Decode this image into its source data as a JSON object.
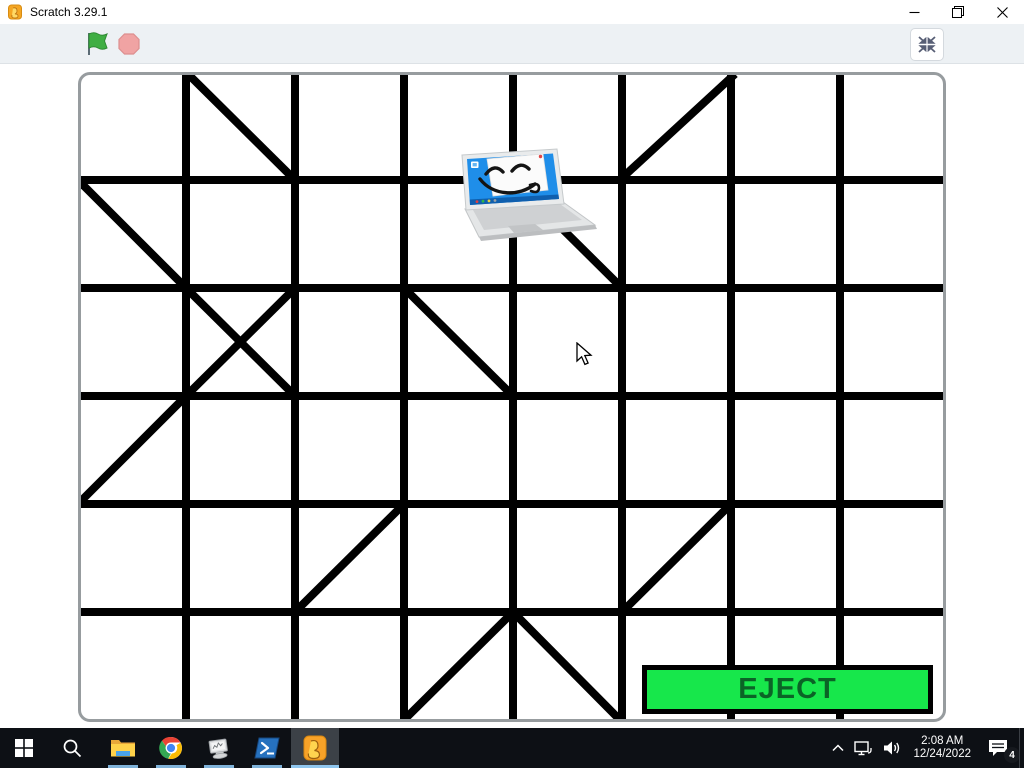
{
  "window": {
    "title": "Scratch 3.29.1",
    "app_icon": "scratch-app-icon",
    "controls": {
      "minimize": "minimize",
      "restore": "restore-down",
      "close": "close"
    }
  },
  "control_bar": {
    "green_flag_icon": "green-flag",
    "stop_icon": "stop-sign",
    "fullscreen_icon": "exit-fullscreen",
    "flag_color": "#3fae43",
    "stop_color": "#f0a3a3"
  },
  "stage": {
    "background": "#ffffff",
    "sprite": {
      "name": "laptop-character",
      "screen_color": "#1f8ee9"
    },
    "eject_button": {
      "label": "EJECT",
      "fill": "#17e74b",
      "text_color": "#0b6326",
      "border_color": "#000000"
    },
    "maze": {
      "line_color": "#000000",
      "line_width": 8,
      "width": 868,
      "height": 650,
      "verticals": [
        108,
        217,
        326,
        435,
        544,
        653,
        762
      ],
      "horizontals": [
        108,
        216,
        324,
        432,
        540
      ],
      "diagonals": [
        [
          108,
          0,
          217,
          108
        ],
        [
          544,
          106,
          657,
          2
        ],
        [
          0,
          108,
          108,
          216
        ],
        [
          435,
          108,
          544,
          216
        ],
        [
          108,
          216,
          217,
          324
        ],
        [
          217,
          216,
          108,
          324
        ],
        [
          326,
          216,
          435,
          324
        ],
        [
          0,
          432,
          108,
          324
        ],
        [
          217,
          540,
          326,
          432
        ],
        [
          544,
          540,
          653,
          432
        ],
        [
          326,
          648,
          435,
          540
        ],
        [
          435,
          540,
          544,
          650
        ]
      ]
    }
  },
  "taskbar": {
    "apps": [
      {
        "name": "start",
        "running": false
      },
      {
        "name": "search",
        "running": false
      },
      {
        "name": "file-explorer",
        "running": true
      },
      {
        "name": "chrome",
        "running": true
      },
      {
        "name": "utility-app",
        "running": true
      },
      {
        "name": "powershell",
        "running": true
      },
      {
        "name": "scratch",
        "running": true,
        "active": true
      }
    ],
    "tray": {
      "chevron_icon": "hidden-icons-chevron",
      "network_icon": "network-display",
      "volume_icon": "speaker",
      "time": "2:08 AM",
      "date": "12/24/2022",
      "notifications_badge": "4"
    }
  }
}
